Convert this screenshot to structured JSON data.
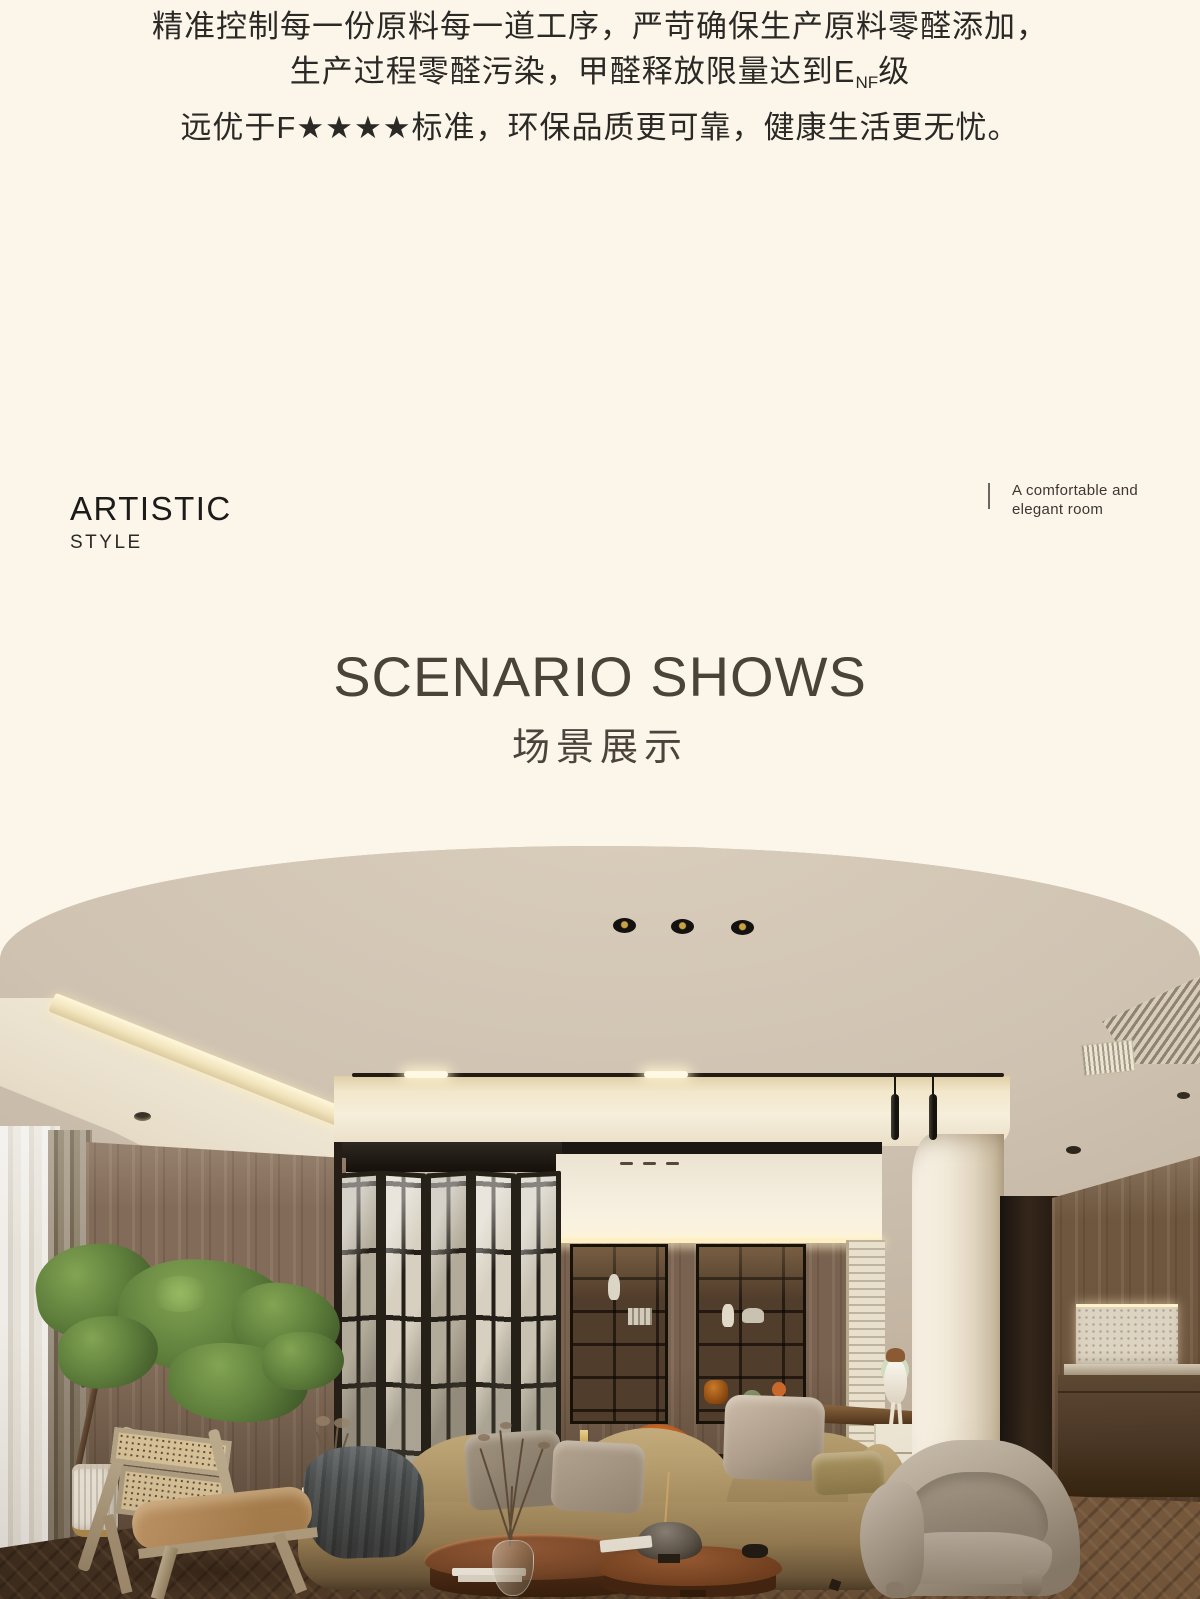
{
  "intro": {
    "line1": "精准控制每一份原料每一道工序，严苛确保生产原料零醛添加，",
    "line2_prefix": "生产过程零醛污染，甲醛释放限量达到E",
    "line2_subscript": "NF",
    "line2_suffix": "级",
    "line3": "远优于F★★★★标准，环保品质更可靠，健康生活更无忧。"
  },
  "style_block": {
    "title": "ARTISTIC",
    "subtitle": "STYLE"
  },
  "side_note": {
    "line1": "A comfortable and",
    "line2": "elegant room"
  },
  "section": {
    "title_en": "SCENARIO SHOWS",
    "title_zh": "场景展示"
  },
  "scene": {
    "alt": "Warm modern living room photo with arched top edge: beige ceiling with three recessed spotlights and a magnetic track light, black folding glass doors, built-in walnut bookshelves with decor, tan fabric sofa with pillows and a gray throw, rattan cane lounge chair, round walnut coffee tables with a bowl and dried branches, greige boucle armchair, white column, wood-paneled walls with lit stone niche, indoor tree in a ribbed white pot, sheer curtains and herringbone wood floor",
    "palette": {
      "page_background": "#fcf6ea",
      "ceiling_tan": "#cbbeac",
      "cove_light": "#f7ecc9",
      "wood_wall": "#826c59",
      "door_frame": "#262118",
      "sofa_tan": "#a98f60",
      "pillow_velvet": "#b7a896",
      "throw_gray": "#4d5050",
      "floor_wood": "#553f2c",
      "column_cream": "#f1e9d8",
      "accent_orange": "#b85c2d",
      "foliage_green": "#5d7d3b",
      "rattan_cane": "#d9c49a",
      "boucle_greige": "#b2a694"
    }
  }
}
